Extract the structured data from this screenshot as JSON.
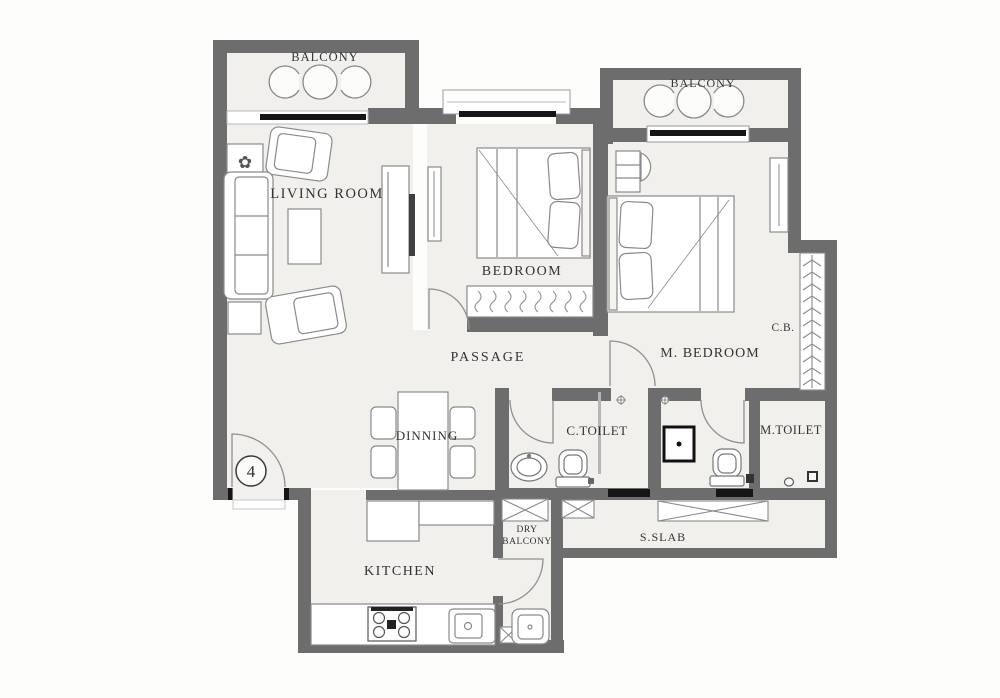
{
  "plan": {
    "unit_number": "4",
    "labels": {
      "balcony_left": "BALCONY",
      "balcony_right": "BALCONY",
      "living_room": "LIVING ROOM",
      "bedroom": "BEDROOM",
      "master_bedroom": "M. BEDROOM",
      "passage": "PASSAGE",
      "dinning": "DINNING",
      "common_toilet": "C.TOILET",
      "master_toilet": "M.TOILET",
      "cupboard": "C.B.",
      "dry_balcony_line1": "DRY",
      "dry_balcony_line2": "BALCONY",
      "service_slab": "S.SLAB",
      "kitchen": "KITCHEN"
    },
    "colors": {
      "wall": "#6d6d6d",
      "floor": "#f1f0ec",
      "accent_black": "#151515"
    }
  }
}
